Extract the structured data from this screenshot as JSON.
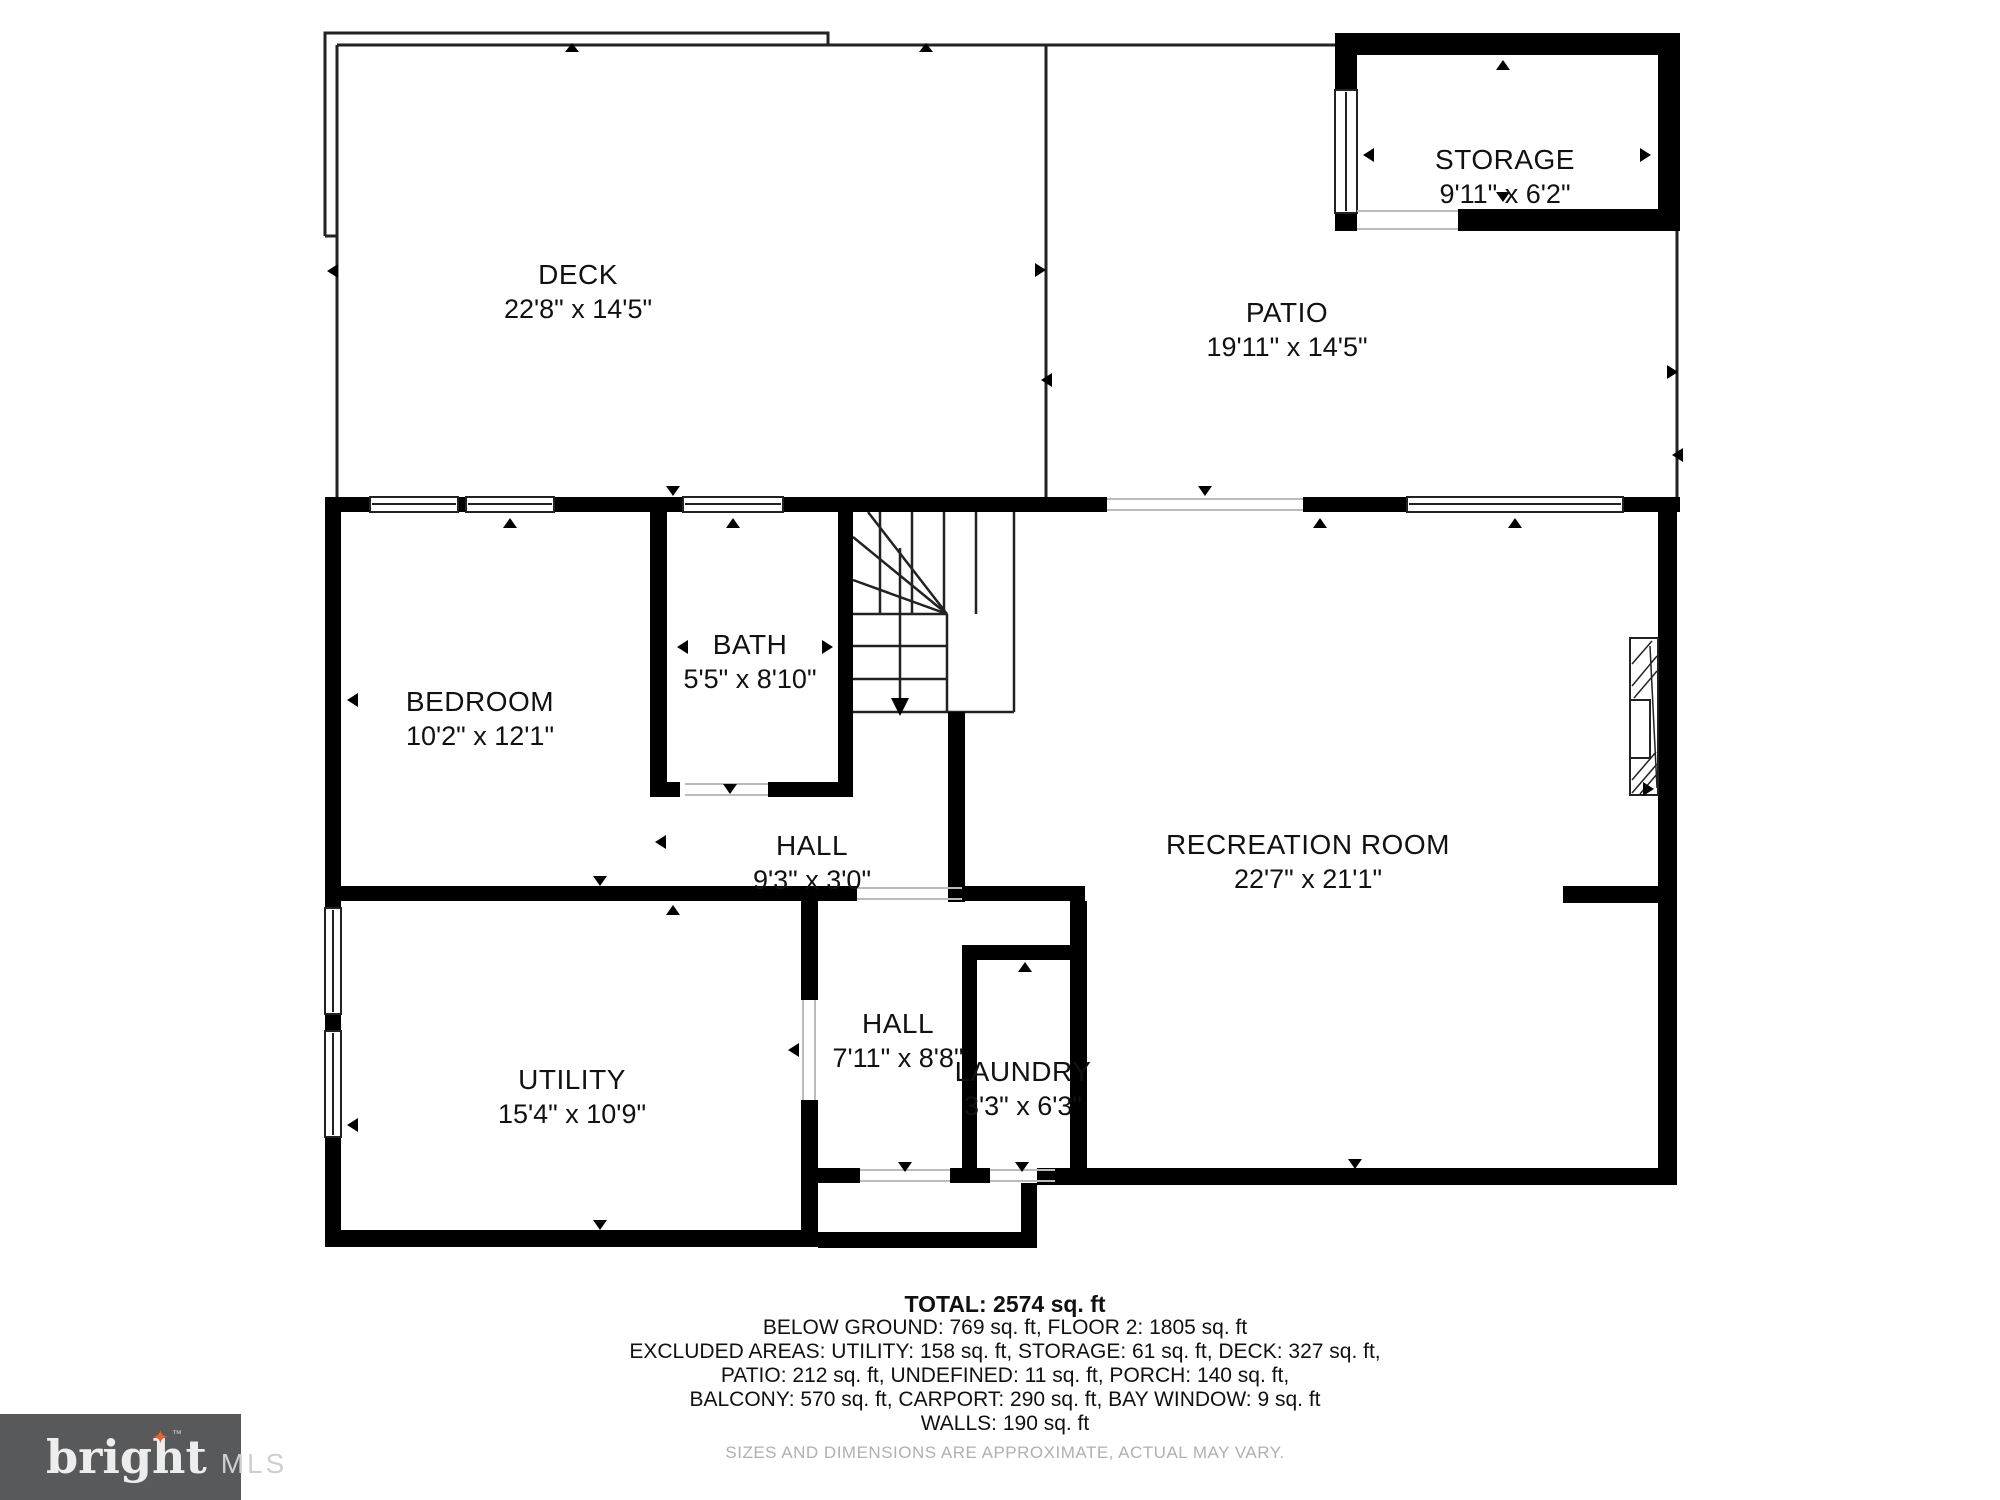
{
  "plan": {
    "rooms": [
      {
        "name": "DECK",
        "dims": "22'8\" x 14'5\""
      },
      {
        "name": "STORAGE",
        "dims": "9'11\" x 6'2\""
      },
      {
        "name": "PATIO",
        "dims": "19'11\" x 14'5\""
      },
      {
        "name": "BEDROOM",
        "dims": "10'2\" x 12'1\""
      },
      {
        "name": "BATH",
        "dims": "5'5\" x 8'10\""
      },
      {
        "name": "HALL",
        "dims": "9'3\" x 3'0\""
      },
      {
        "name": "RECREATION ROOM",
        "dims": "22'7\" x 21'1\""
      },
      {
        "name": "UTILITY",
        "dims": "15'4\" x 10'9\""
      },
      {
        "name": "HALL",
        "dims": "7'11\" x 8'8\""
      },
      {
        "name": "LAUNDRY",
        "dims": "3'3\" x 6'3\""
      }
    ],
    "summary": {
      "total": "TOTAL: 2574 sq. ft",
      "line1": "BELOW GROUND: 769 sq. ft, FLOOR 2: 1805 sq. ft",
      "line2": "EXCLUDED AREAS: UTILITY: 158 sq. ft, STORAGE: 61 sq. ft, DECK: 327 sq. ft,",
      "line3": "PATIO: 212 sq. ft, UNDEFINED: 11 sq. ft, PORCH: 140 sq. ft,",
      "line4": "BALCONY: 570 sq. ft, CARPORT: 290 sq. ft, BAY WINDOW: 9 sq. ft",
      "line5": "WALLS: 190 sq. ft",
      "disclaimer": "SIZES AND DIMENSIONS ARE APPROXIMATE, ACTUAL MAY VARY."
    },
    "logo": {
      "brand": "bright",
      "mls": "MLS",
      "tm": "™",
      "star": "✦"
    },
    "colors": {
      "wall": "#000000",
      "thin_line": "#222222",
      "door_line": "#bbbbbb",
      "text": "#111111",
      "disclaimer_text": "#b0b0b0",
      "logo_bg": "#58595a",
      "logo_text": "#ededed",
      "logo_mls_text": "#cfcfcf",
      "star": "#e8622d"
    }
  }
}
